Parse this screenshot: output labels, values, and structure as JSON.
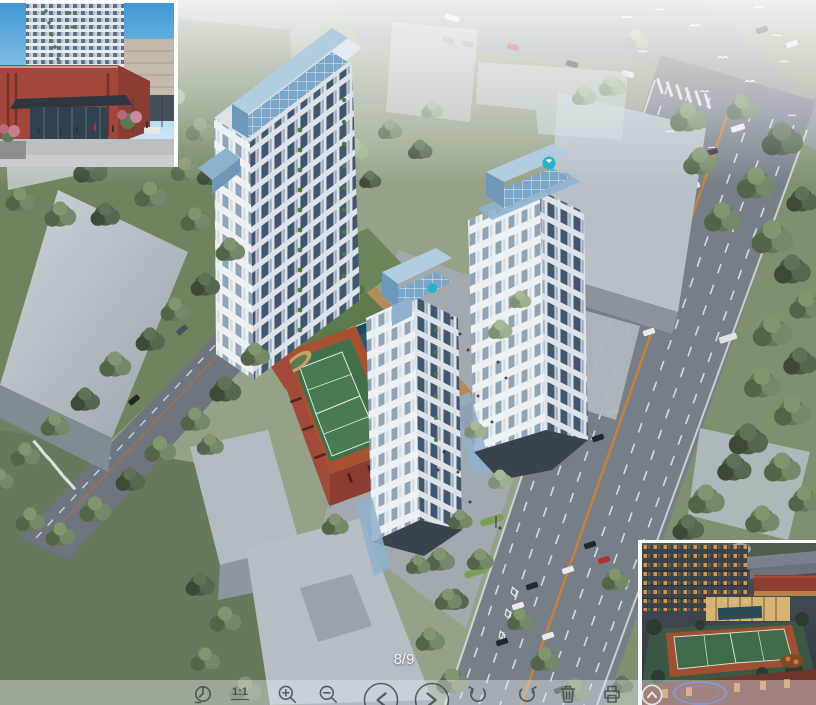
{
  "viewer": {
    "page_indicator": "8/9",
    "toolbar": {
      "actual_size_label": "1:1",
      "buttons": [
        {
          "name": "fit-to-window",
          "icon": "fit-to-window-icon"
        },
        {
          "name": "actual-size",
          "icon": "one-to-one-icon",
          "label": "1:1"
        },
        {
          "name": "zoom-in",
          "icon": "zoom-in-icon"
        },
        {
          "name": "zoom-out",
          "icon": "zoom-out-icon"
        },
        {
          "name": "previous-image",
          "icon": "chevron-left-icon"
        },
        {
          "name": "next-image",
          "icon": "chevron-right-icon"
        },
        {
          "name": "rotate-left",
          "icon": "rotate-left-icon"
        },
        {
          "name": "rotate-right",
          "icon": "rotate-right-icon"
        },
        {
          "name": "delete",
          "icon": "trash-icon"
        },
        {
          "name": "print",
          "icon": "printer-icon"
        },
        {
          "name": "collapse-toolbar",
          "icon": "chevron-up-icon"
        }
      ]
    }
  },
  "image": {
    "subject": "Aerial architectural rendering of a residential complex: three white high-rise towers with blue glass crowns, landscaped podium courtyard with swimming pool and tennis courts, red brick podium, surrounded by roads with traffic, gray neighboring buildings and dense trees; flock of white birds over park at top right",
    "insets": {
      "bottom_left": "Street-level rendering of residential tower entrance with red brick podium and dark glass canopy, people on plaza",
      "bottom_right": "Dusk rendering of rooftop tennis courts, lit clubhouse glazing and surrounding mid-rise buildings, blue oval watermark stamp"
    },
    "palette": {
      "tree_green": "#64775a",
      "road_gray": "#767e88",
      "lane_orange": "#c8813d",
      "facade_white": "#edf1f4",
      "window_blue": "#41566f",
      "glass_crown_blue": "#7ca6c8",
      "podium_red": "#a24a3a",
      "court_green": "#41714a",
      "pool_teal": "#1e4a5e",
      "deck_tan": "#b58a58",
      "logo_teal": "#28b2c8",
      "watermark_blue": "#3a5fc0",
      "thumb_sky_blue": "#3f97d4",
      "lit_window_amber": "#d79e54"
    }
  }
}
